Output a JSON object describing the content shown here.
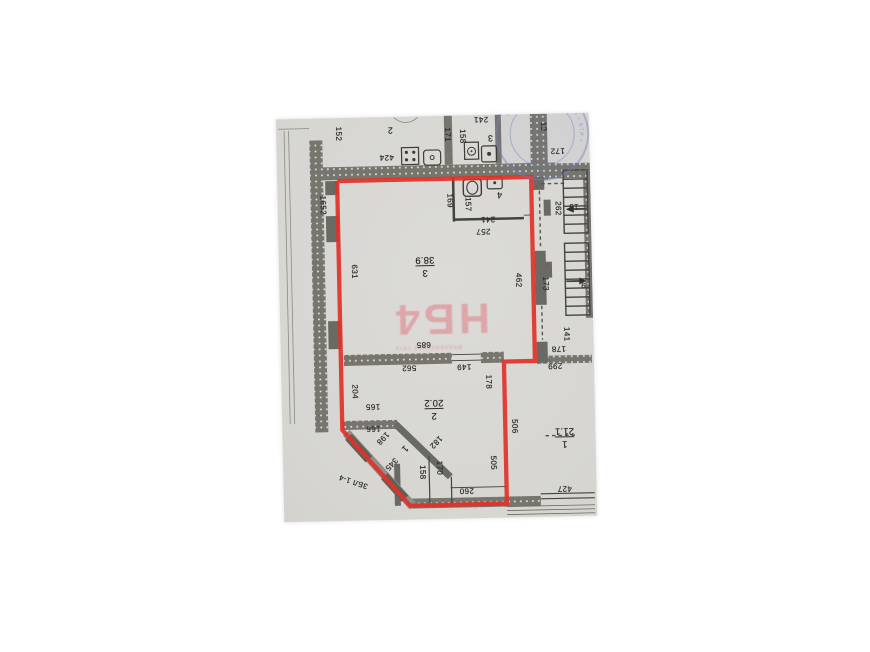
{
  "colors": {
    "background": "#ffffff",
    "paper": "#d8d7d3",
    "ink": "#2e2e2b",
    "wall_fill": "#76766f",
    "wall_dark": "#6a6a64",
    "red_outline": "#e23128",
    "watermark_pink": "#e0777f",
    "stamp_blue": "#6a74b8"
  },
  "watermark": {
    "text": "НБ4",
    "subtext": "федеральная сеть"
  },
  "stamp": {
    "arc_text": "МОСКОВСКОЙ ОБЛАСТИ • БТИ •"
  },
  "annotation": {
    "outline_points": "60,63 254,63 254,247 223,247 223,389 126,389 60,312 60,63"
  },
  "rooms": [
    {
      "number": "3",
      "area": "38.9"
    },
    {
      "number": "2",
      "area": "20.2"
    },
    {
      "number": "1",
      "area": "21.1"
    },
    {
      "number": "4",
      "area": ""
    }
  ],
  "labels": [
    {
      "t": "152",
      "x": 62,
      "y": 16,
      "r": 90
    },
    {
      "t": "2",
      "x": 114,
      "y": 13,
      "r": 180,
      "fs": 9
    },
    {
      "t": "424",
      "x": 110,
      "y": 40,
      "r": 180
    },
    {
      "t": "171",
      "x": 171,
      "y": 19,
      "r": 90
    },
    {
      "t": "158",
      "x": 186,
      "y": 21,
      "r": 90
    },
    {
      "t": "3",
      "x": 214,
      "y": 23,
      "r": 180,
      "fs": 9
    },
    {
      "t": "241",
      "x": 205,
      "y": 4,
      "r": 180
    },
    {
      "t": "12",
      "x": 267,
      "y": 13,
      "r": 90
    },
    {
      "t": "172",
      "x": 281,
      "y": 37,
      "r": 180
    },
    {
      "t": "1652",
      "x": 45,
      "y": 87,
      "r": 90
    },
    {
      "t": "262",
      "x": 280,
      "y": 95,
      "r": 90
    },
    {
      "t": "15",
      "x": 296,
      "y": 93,
      "r": 180
    },
    {
      "t": "169",
      "x": 172,
      "y": 85,
      "r": 90
    },
    {
      "t": "157",
      "x": 190,
      "y": 89,
      "r": 90
    },
    {
      "t": "241",
      "x": 210,
      "y": 104,
      "r": 180
    },
    {
      "t": "4",
      "x": 222,
      "y": 80,
      "r": 180,
      "fs": 9
    },
    {
      "t": "257",
      "x": 205,
      "y": 116,
      "r": 180
    },
    {
      "t": "631",
      "x": 75,
      "y": 154,
      "r": 90
    },
    {
      "frac": [
        "3",
        "38.9"
      ],
      "x": 146,
      "y": 150,
      "r": 180
    },
    {
      "t": "462",
      "x": 239,
      "y": 166,
      "r": 90
    },
    {
      "t": "173",
      "x": 266,
      "y": 170,
      "r": 90
    },
    {
      "t": "9",
      "x": 304,
      "y": 172,
      "r": 180
    },
    {
      "t": "685",
      "x": 143,
      "y": 228,
      "r": 180
    },
    {
      "t": "562",
      "x": 128,
      "y": 251,
      "r": 180
    },
    {
      "t": "149",
      "x": 183,
      "y": 251,
      "r": 180
    },
    {
      "t": "178",
      "x": 207,
      "y": 267,
      "r": 90
    },
    {
      "t": "141",
      "x": 286,
      "y": 221,
      "r": 90
    },
    {
      "t": "178",
      "x": 278,
      "y": 235,
      "r": 180
    },
    {
      "t": "299",
      "x": 274,
      "y": 252,
      "r": 180
    },
    {
      "frac": [
        "2",
        "20.2"
      ],
      "x": 152,
      "y": 293,
      "r": 180
    },
    {
      "t": "204",
      "x": 73,
      "y": 274,
      "r": 90
    },
    {
      "t": "165",
      "x": 91,
      "y": 289,
      "r": 180
    },
    {
      "t": "166",
      "x": 91,
      "y": 311,
      "r": 180
    },
    {
      "t": "198",
      "x": 100,
      "y": 321,
      "r": 135
    },
    {
      "t": "182",
      "x": 153,
      "y": 326,
      "r": 135
    },
    {
      "t": "1",
      "x": 122,
      "y": 332,
      "r": 135,
      "fs": 9
    },
    {
      "t": "345",
      "x": 108,
      "y": 347,
      "r": 135
    },
    {
      "t": "ЗБЛ 1-4",
      "x": 70,
      "y": 364,
      "r": 200,
      "fs": 7.5
    },
    {
      "t": "158",
      "x": 139,
      "y": 356,
      "r": 90
    },
    {
      "t": "170",
      "x": 156,
      "y": 352,
      "r": 90
    },
    {
      "t": "260",
      "x": 183,
      "y": 375,
      "r": 180
    },
    {
      "t": "505",
      "x": 210,
      "y": 348,
      "r": 90
    },
    {
      "t": "506",
      "x": 232,
      "y": 312,
      "r": 90
    },
    {
      "frac": [
        "1",
        "21.1"
      ],
      "x": 282,
      "y": 324,
      "r": 180
    },
    {
      "t": "427",
      "x": 281,
      "y": 375,
      "r": 180
    }
  ]
}
